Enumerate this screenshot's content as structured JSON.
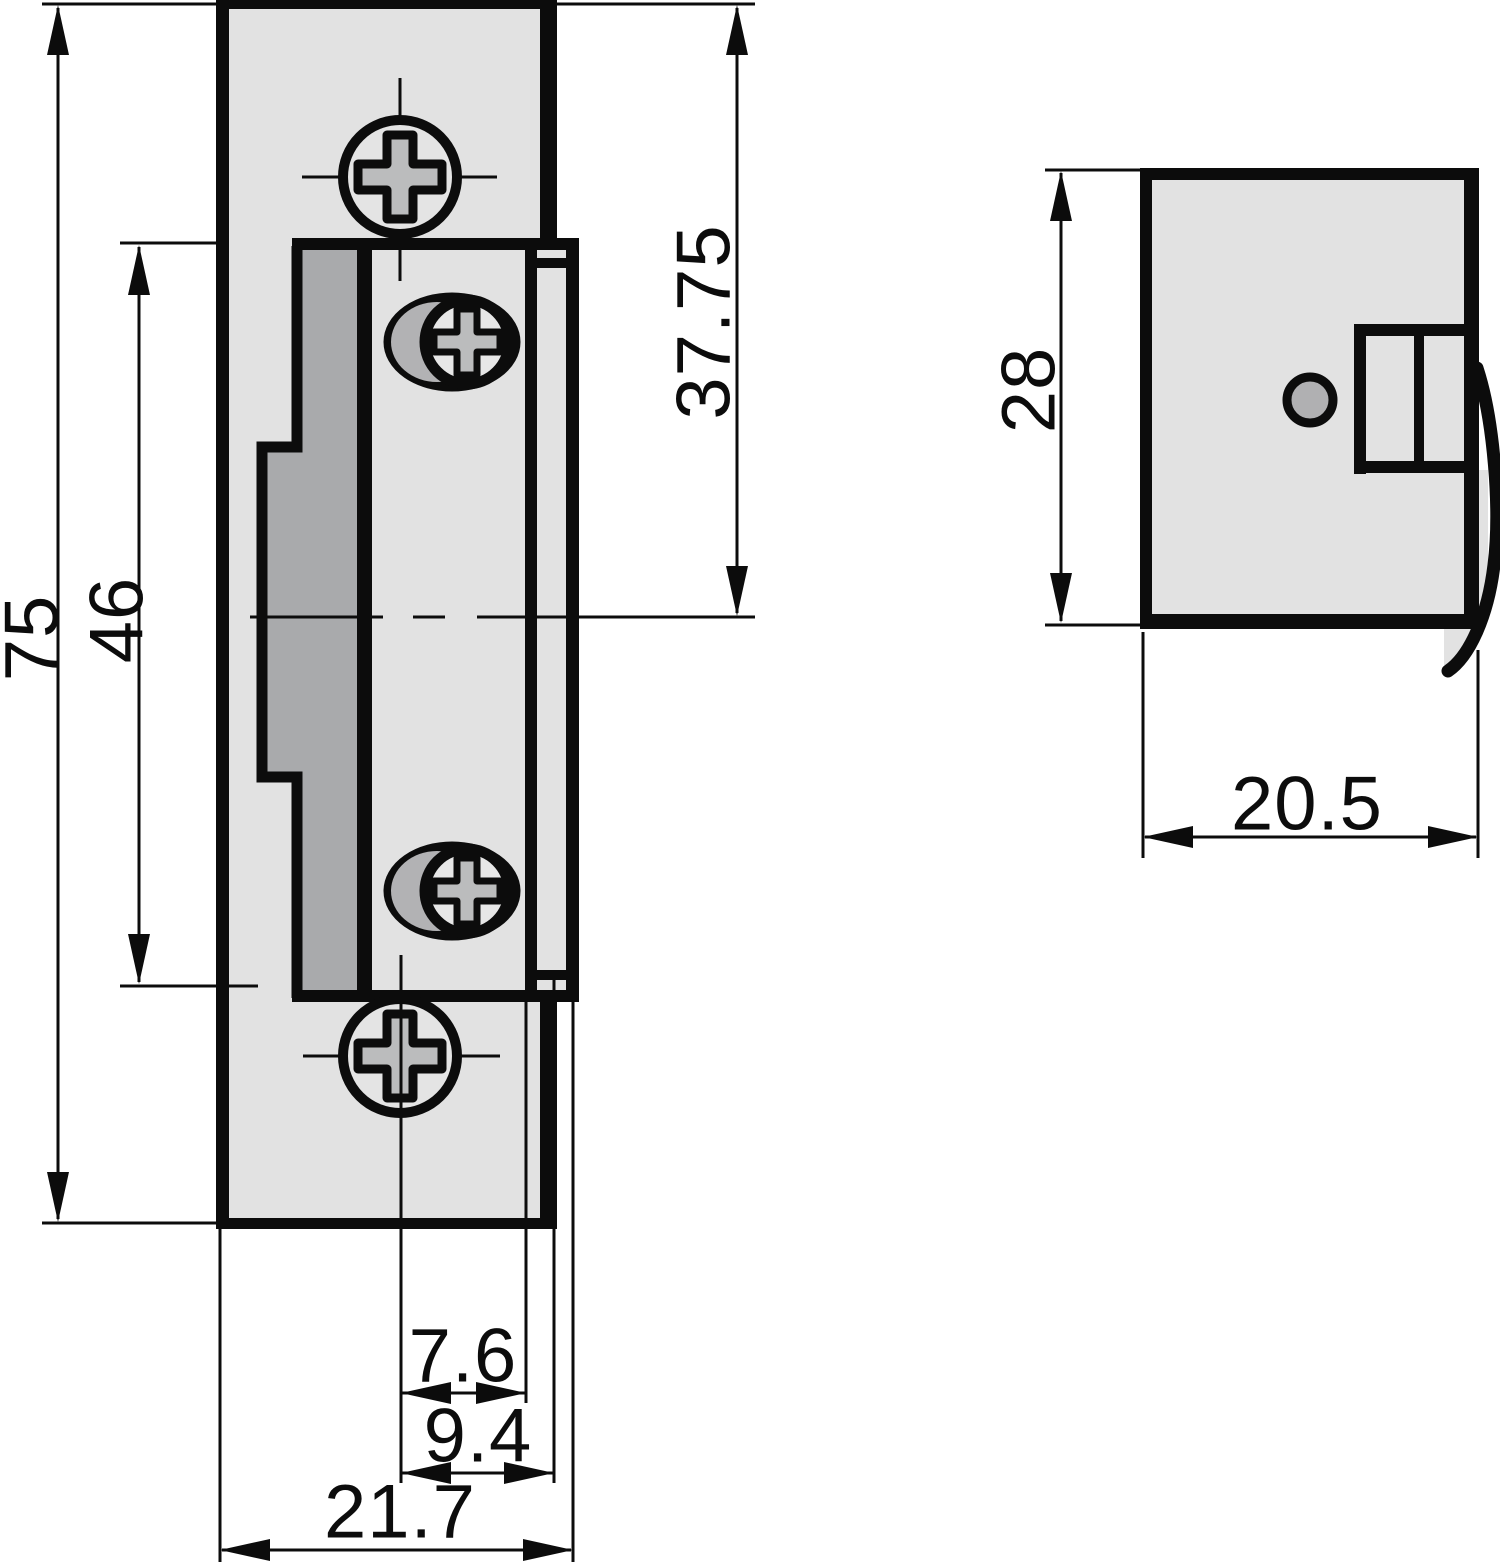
{
  "title": "Electric strike plate dimensional drawing, front and side views",
  "views": {
    "front_view_name": "front-view",
    "side_view_name": "side-view"
  },
  "dimensions": {
    "overall_height_mm": "75",
    "opening_height_mm": "46",
    "top_to_centerline_mm": "37.75",
    "centerline_to_faceplate_edge_mm": "7.6",
    "centerline_to_lip_edge_mm": "9.4",
    "overall_width_mm": "21.7",
    "side_body_height_mm": "28",
    "side_body_depth_mm": "20.5"
  },
  "colors": {
    "line": "#0c0c0c",
    "plate_fill": "#e2e2e2",
    "cavity_fill": "#a9aaac",
    "screw_slot_fill": "#bbbcbd",
    "hole_fill": "#b0b0b2",
    "background": "#ffffff"
  }
}
